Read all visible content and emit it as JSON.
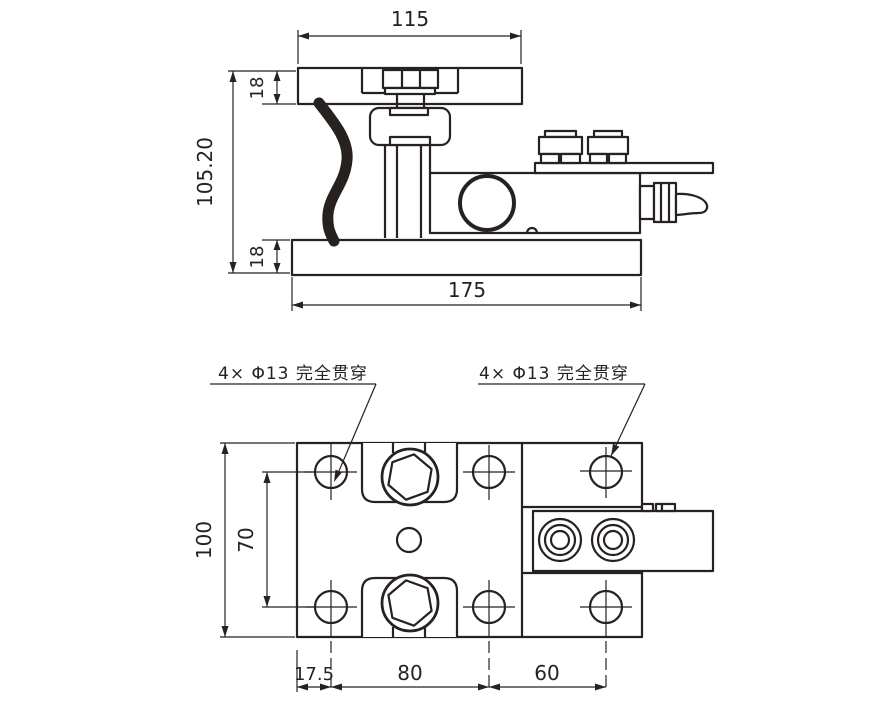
{
  "drawing": {
    "title": "weighing-module-technical-drawing",
    "colors": {
      "line": "#272220",
      "background": "#ffffff"
    },
    "side_view": {
      "dims": {
        "top_plate_width": "115",
        "top_plate_thickness": "18",
        "overall_height": "105.20",
        "bottom_plate_thickness": "18",
        "bottom_plate_width": "175"
      }
    },
    "plan_view": {
      "labels": {
        "left_holes": "4× Φ13 完全贯穿",
        "right_holes": "4× Φ13 完全贯穿"
      },
      "dims": {
        "plate_height": "100",
        "hole_spacing_vertical": "70",
        "edge_to_first_hole": "17.5",
        "hole_spacing_horizontal": "80",
        "right_hole_offset": "60"
      }
    }
  }
}
